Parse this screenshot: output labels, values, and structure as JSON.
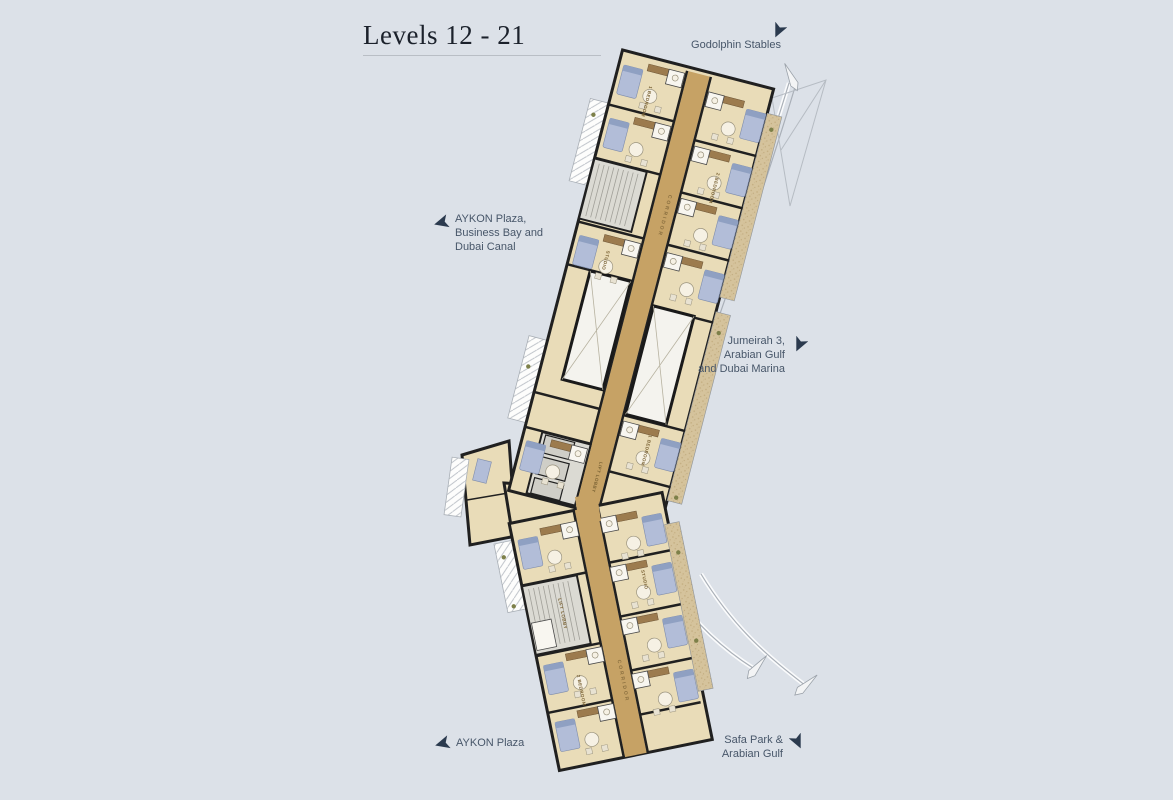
{
  "page": {
    "background_color": "#dce1e8"
  },
  "title": {
    "text": "Levels 12 - 21"
  },
  "directions": {
    "godolphin": {
      "line1": "Godolphin Stables"
    },
    "aykon_plaza_canal": {
      "line1": "AYKON Plaza,",
      "line2": "Business Bay and",
      "line3": "Dubai Canal"
    },
    "jumeirah": {
      "line1": "Jumeirah 3,",
      "line2": "Arabian Gulf",
      "line3": "and Dubai Marina"
    },
    "aykon_plaza": {
      "line1": "AYKON Plaza"
    },
    "safa_park": {
      "line1": "Safa Park &",
      "line2": "Arabian Gulf"
    }
  },
  "plan": {
    "corridor_label": "CORRIDOR",
    "corridor_label_lower": "CORRIDOR",
    "lift_lobby_label": "LIFT LOBBY",
    "lift_lobby_label_lower": "LIFT LOBBY",
    "room_labels": [
      "1 BEDROOM",
      "2 BEDROOM",
      "STUDIO",
      "1 BEDROOM",
      "2 BEDROOM",
      "STUDIO"
    ],
    "colors": {
      "floor": "#e9dcb8",
      "corridor": "#c6a265",
      "walls": "#202020",
      "furniture_blue": "#b2bdd8",
      "core_gray": "#dbdad3",
      "balcony_tan": "#d5c39c",
      "background": "#dce1e8",
      "label_text": "#475669",
      "title_text": "#1b212b"
    }
  }
}
